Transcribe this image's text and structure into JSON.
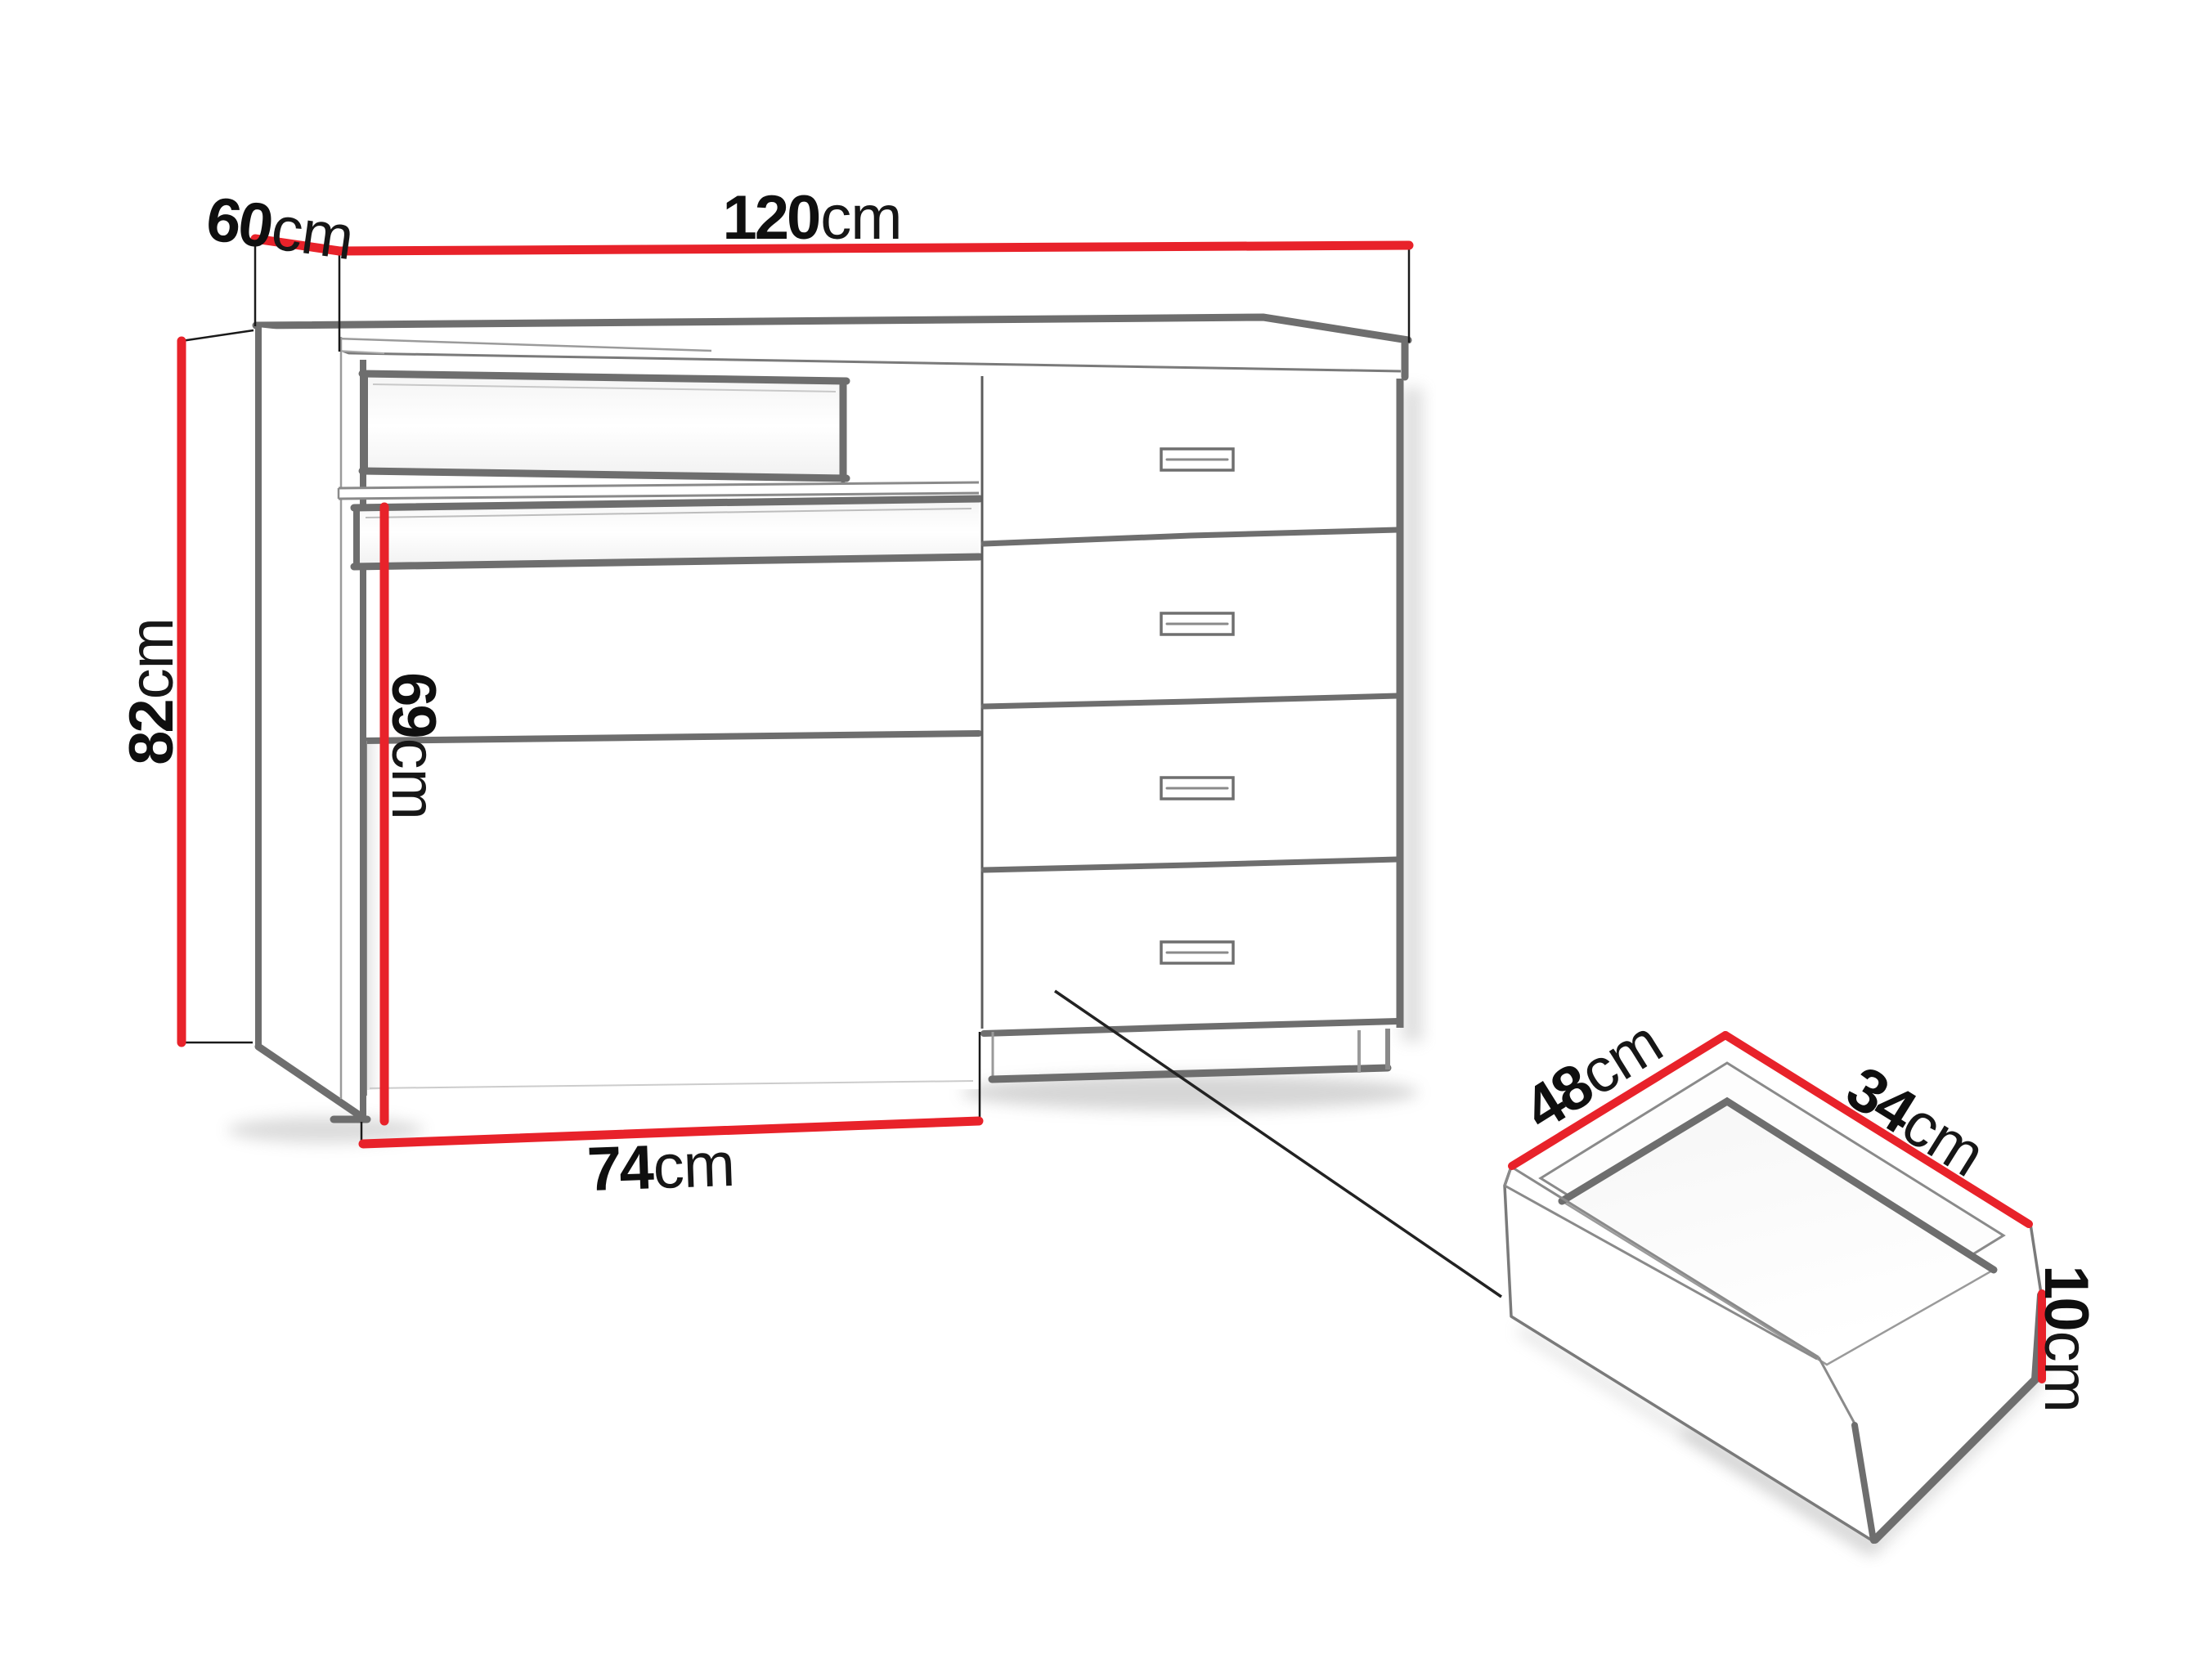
{
  "page": {
    "background": "#ffffff",
    "type": "furniture-dimension-diagram"
  },
  "colors": {
    "dimension_line_red": "#e8222a",
    "furniture_line_gray": "#6e6e6e",
    "extension_line_black": "#1a1a1a",
    "label_text": "#0f0f0f"
  },
  "diagram": {
    "desk": {
      "drawer_count": 4,
      "dimensions": {
        "width": {
          "num": "120",
          "unit": "cm"
        },
        "depth": {
          "num": "60",
          "unit": "cm"
        },
        "height": {
          "num": "82",
          "unit": "cm"
        },
        "underdesk_clearance": {
          "num": "69",
          "unit": "cm"
        },
        "base_width": {
          "num": "74",
          "unit": "cm"
        }
      }
    },
    "drawer_box": {
      "dimensions": {
        "depth": {
          "num": "48",
          "unit": "cm"
        },
        "width": {
          "num": "34",
          "unit": "cm"
        },
        "height": {
          "num": "10",
          "unit": "cm"
        }
      }
    }
  }
}
